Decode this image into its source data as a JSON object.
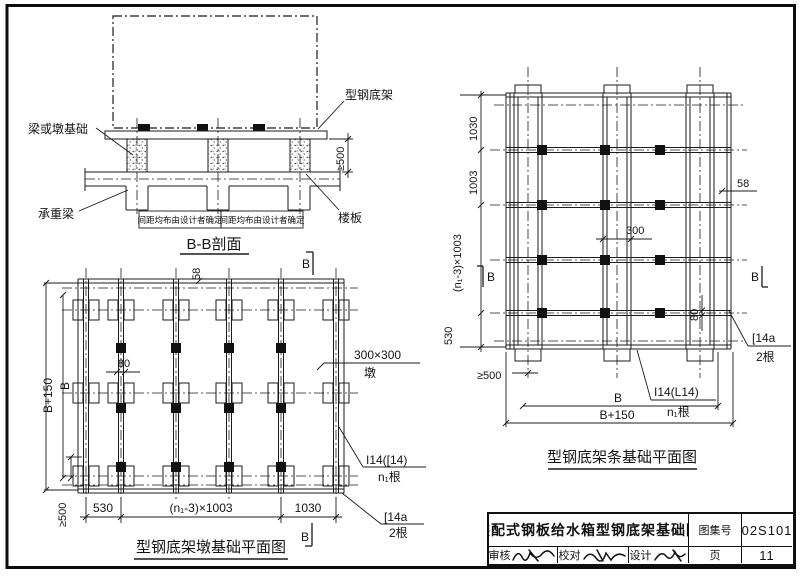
{
  "section": {
    "title": "B-B剖面",
    "labels": {
      "beam_or_pier_foundation": "梁或墩基础",
      "steel_base_frame": "型钢底架",
      "bearing_beam": "承重梁",
      "floor_slab": "楼板"
    },
    "dims": {
      "clearance": "≥500",
      "spacing_note": "间距均布由设计者确定"
    }
  },
  "pier_plan": {
    "title": "型钢底架墩基础平面图",
    "dims": {
      "b_plus_150": "B+150",
      "b": "B",
      "clearance": "≥500",
      "d530": "530",
      "d_n1003": "(n₁-3)×1003",
      "d1030": "1030",
      "d58": "58",
      "d80": "80"
    },
    "labels": {
      "pier_size": "300×300",
      "pier_word": "墩",
      "i_beam": "I14([14)",
      "i_beam_count": "n₁根",
      "channel": "[14a",
      "channel_count": "2根",
      "section_mark": "B"
    }
  },
  "strip_plan": {
    "title": "型钢底架条基础平面图",
    "dims": {
      "d1030": "1030",
      "d1003": "1003",
      "d_n1003": "(n₁-3)×1003",
      "d530": "530",
      "d58": "58",
      "d300": "300",
      "d80": "80",
      "clearance": "≥500",
      "b": "B",
      "b_plus_150": "B+150"
    },
    "labels": {
      "channel": "[14a",
      "channel_count": "2根",
      "i_beam": "I14(L14)",
      "i_beam_count": "n₁根",
      "section_mark": "B"
    }
  },
  "title_block": {
    "drawing_title": "装配式钢板给水箱型钢底架基础图",
    "atlas_no_label": "图集号",
    "atlas_no": "02S101",
    "page_label": "页",
    "page_no": "11",
    "reviewer_label": "审核",
    "checker_label": "校对",
    "designer_label": "设计"
  }
}
